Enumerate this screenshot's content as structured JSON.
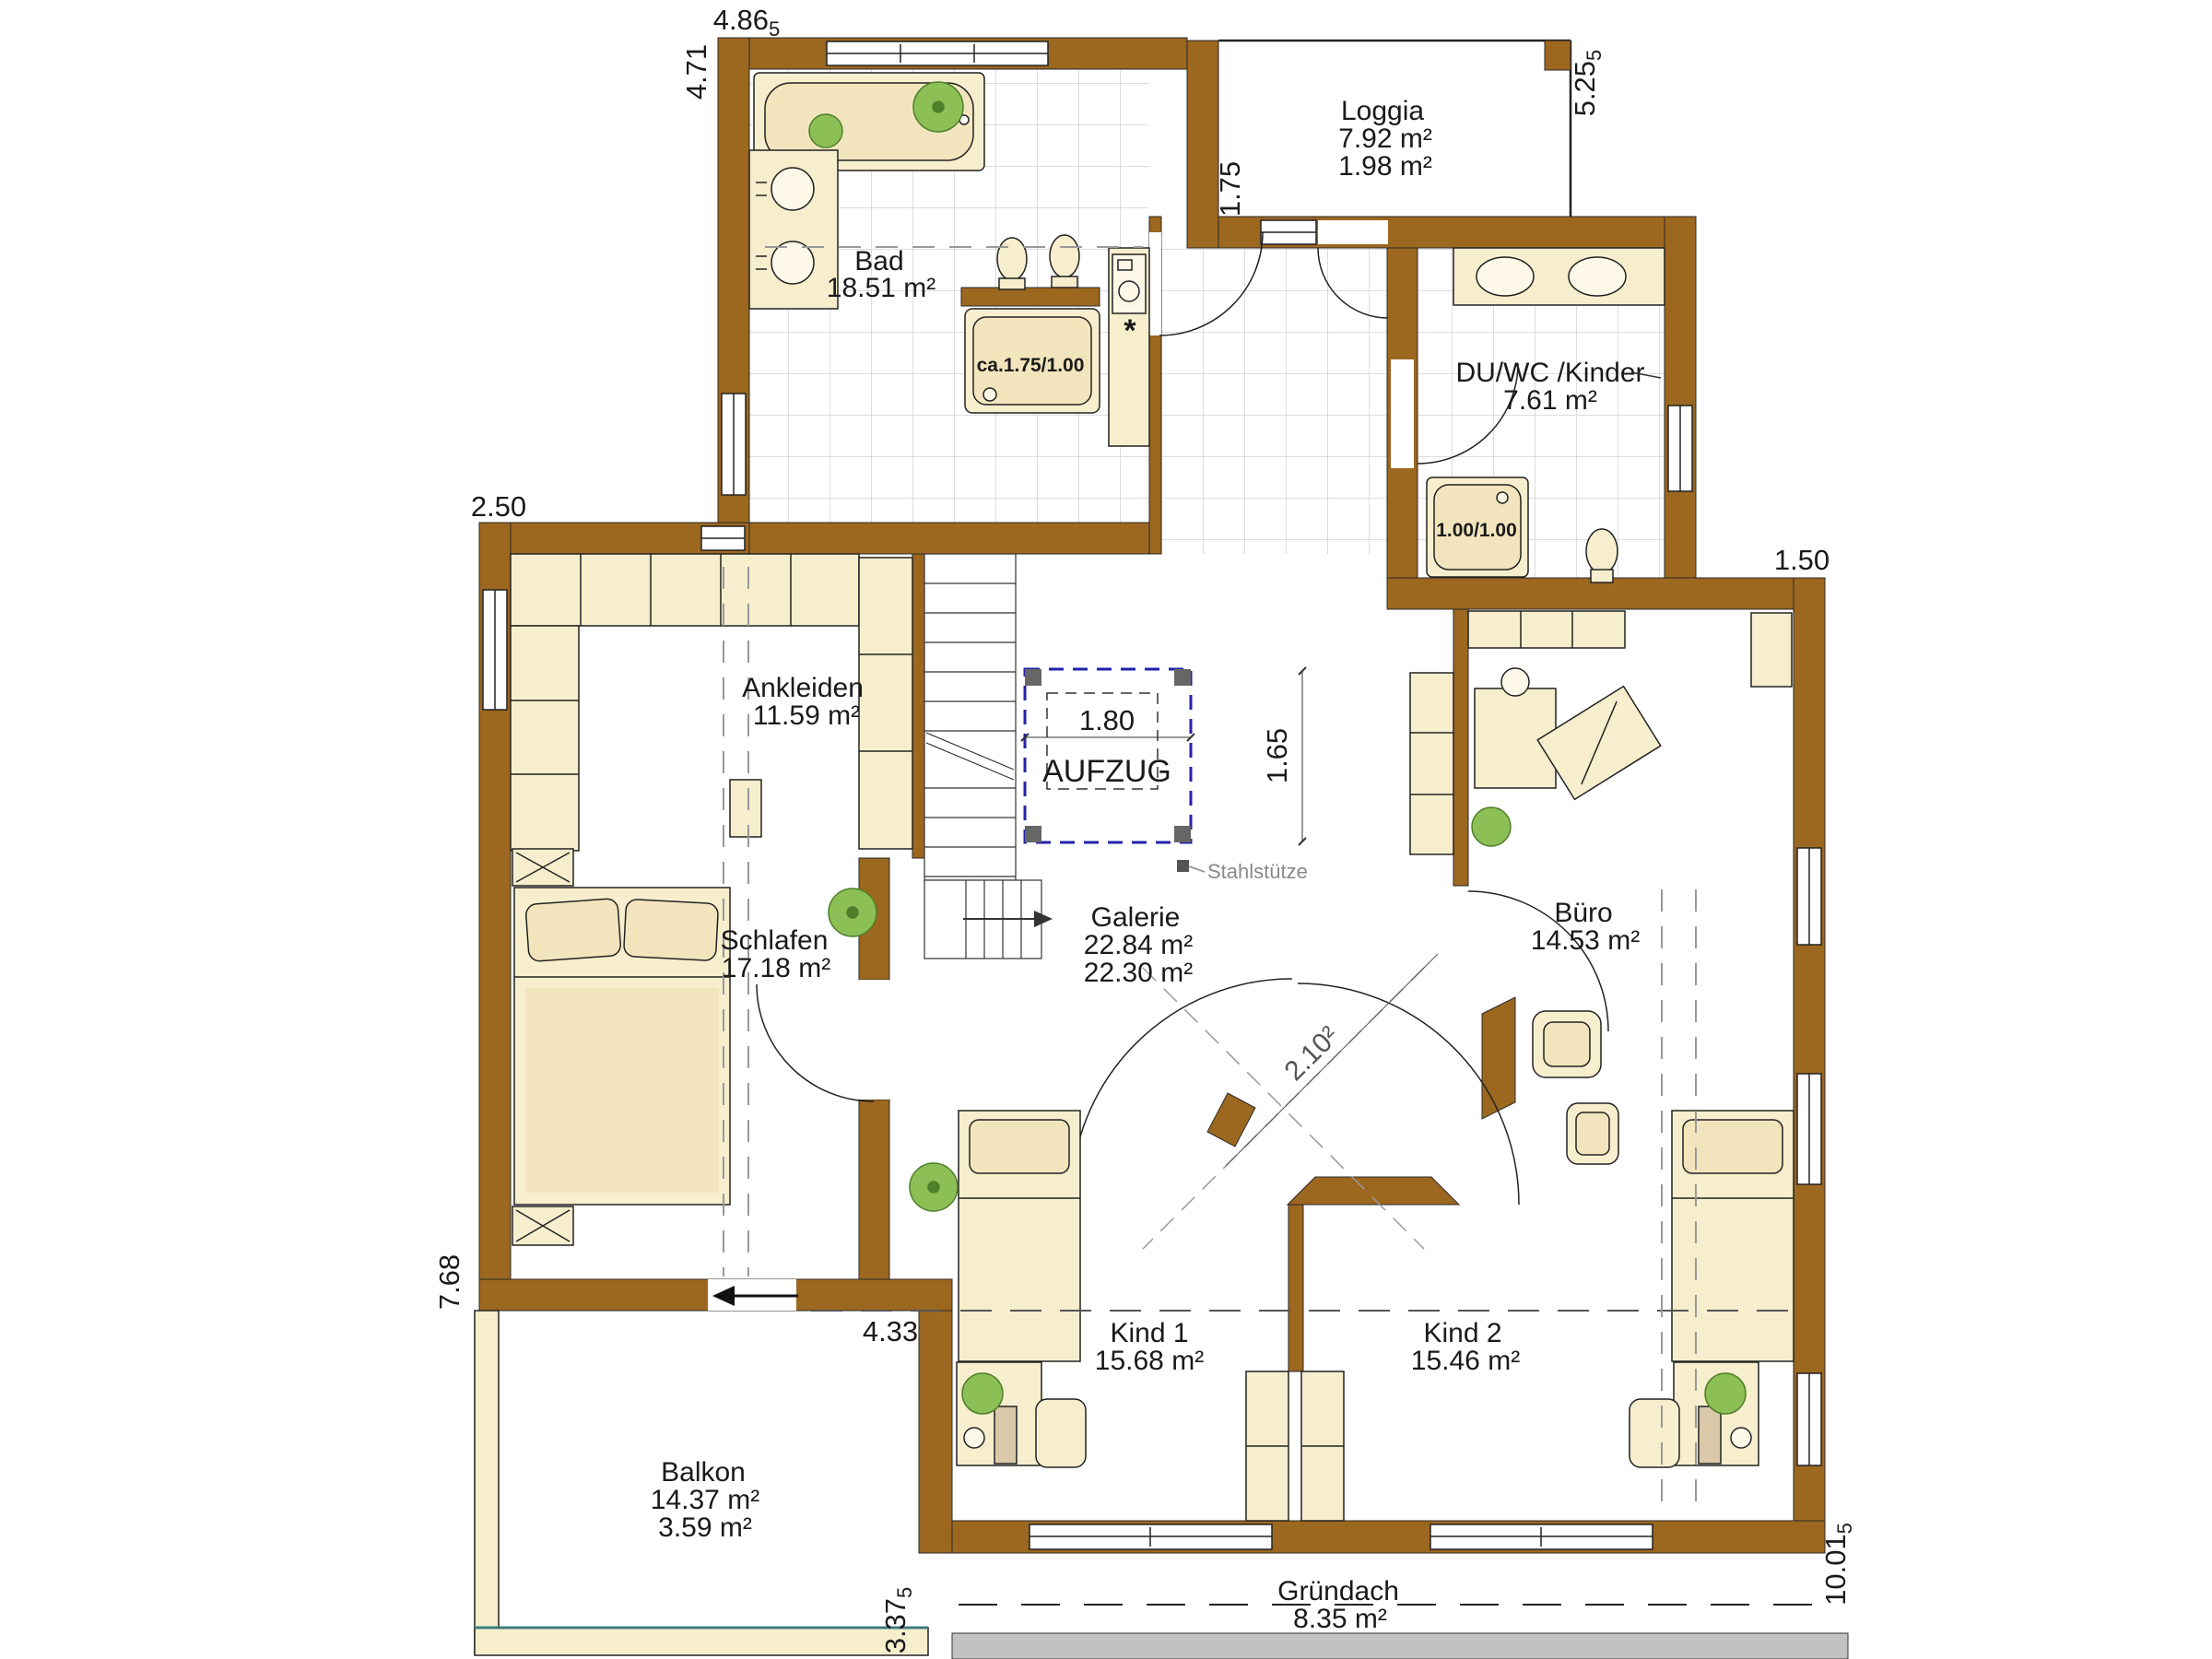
{
  "rooms": {
    "bad": {
      "name": "Bad",
      "area": "18.51 m²"
    },
    "loggia": {
      "name": "Loggia",
      "area": "7.92 m²",
      "area2": "1.98 m²"
    },
    "duwc": {
      "name": "DU/WC /Kinder",
      "area": "7.61 m²"
    },
    "ankleiden": {
      "name": "Ankleiden",
      "area": "11.59 m²"
    },
    "schlafen": {
      "name": "Schlafen",
      "area": "17.18 m²"
    },
    "galerie": {
      "name": "Galerie",
      "area": "22.84 m²",
      "area2": "22.30 m²"
    },
    "buero": {
      "name": "Büro",
      "area": "14.53 m²"
    },
    "kind1": {
      "name": "Kind 1",
      "area": "15.68 m²"
    },
    "kind2": {
      "name": "Kind 2",
      "area": "15.46 m²"
    },
    "balkon": {
      "name": "Balkon",
      "area": "14.37 m²",
      "area2": "3.59 m²"
    },
    "gruendach": {
      "name": "Gründach",
      "area": "8.35 m²"
    }
  },
  "elevator": {
    "label": "AUFZUG",
    "width": "1.80",
    "depth": "1.65"
  },
  "fixtures": {
    "tub_label": "ca.1.75/1.00",
    "shower_label": "1.00/1.00",
    "washer_mark": "*"
  },
  "annotations": {
    "steel_column": "Stahlstütze"
  },
  "dimensions": {
    "top_width": "4.86",
    "top_width_sub": "5",
    "left_top_height": "4.71",
    "loggia_height": "5.25",
    "loggia_height_sub": "5",
    "loggia_depth": "1.75",
    "left_wing_offset": "2.50",
    "right_wing_offset": "1.50",
    "left_height": "7.68",
    "bottom_offset": "4.33",
    "balcony_height": "3.37",
    "balcony_height_sub": "5",
    "right_height": "10.01",
    "right_height_sub": "5",
    "gallery_diagonal": "2.10²"
  },
  "colors": {
    "wall": "#9c671f",
    "furniture": "#f7eecd",
    "accent_red": "#cc1111",
    "elevator_blue": "#2222aa",
    "plant_green": "#8cbf56",
    "roof_gray": "#c2c2c2",
    "teal": "#3e7d7d"
  }
}
